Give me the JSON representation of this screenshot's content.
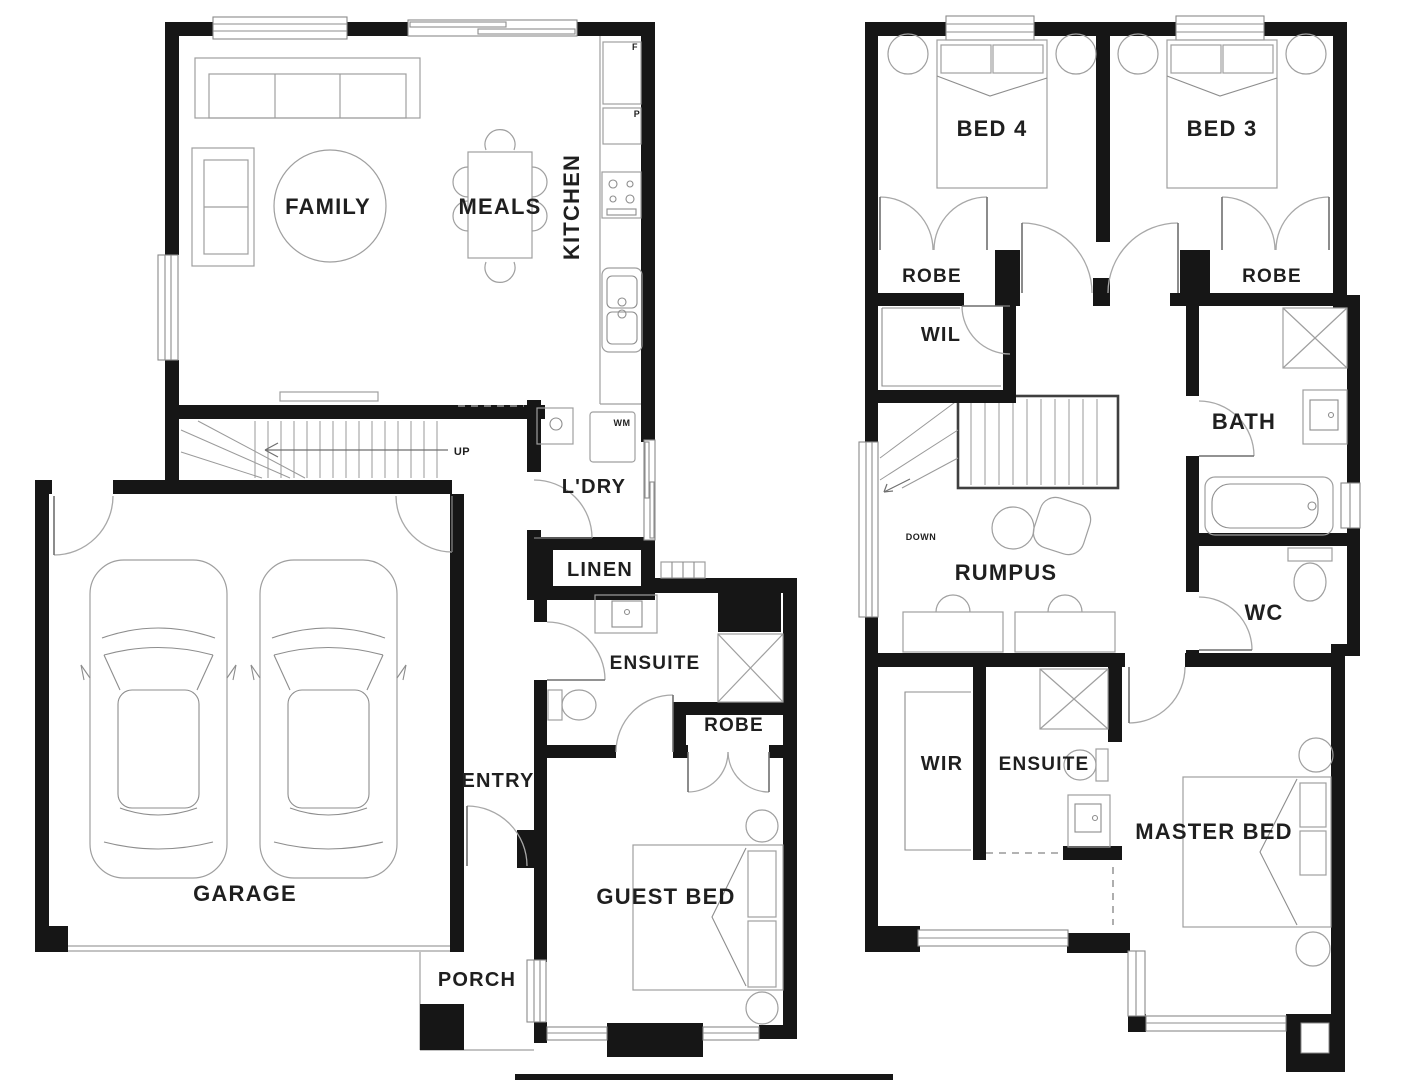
{
  "ground_floor": {
    "rooms": {
      "family": "FAMILY",
      "meals": "MEALS",
      "kitchen": "KITCHEN",
      "laundry": "L'DRY",
      "linen": "LINEN",
      "ensuite": "ENSUITE",
      "robe": "ROBE",
      "entry": "ENTRY",
      "garage": "GARAGE",
      "porch": "PORCH",
      "guest_bed": "GUEST BED"
    },
    "annotations": {
      "stairs_up": "UP",
      "washing_machine": "WM",
      "fridge": "F",
      "pantry": "P"
    }
  },
  "upper_floor": {
    "rooms": {
      "bed4": "BED 4",
      "bed3": "BED 3",
      "robe_bed4": "ROBE",
      "robe_bed3": "ROBE",
      "walk_in_linen": "WIL",
      "bath": "BATH",
      "rumpus": "RUMPUS",
      "wc": "WC",
      "walk_in_robe": "WIR",
      "ensuite": "ENSUITE",
      "master_bed": "MASTER BED"
    },
    "annotations": {
      "stairs_down": "DOWN"
    }
  },
  "colors": {
    "wall": "#161616",
    "fixture_line": "#9a9a9a",
    "label_text": "#1f1f1f",
    "background": "#ffffff"
  }
}
